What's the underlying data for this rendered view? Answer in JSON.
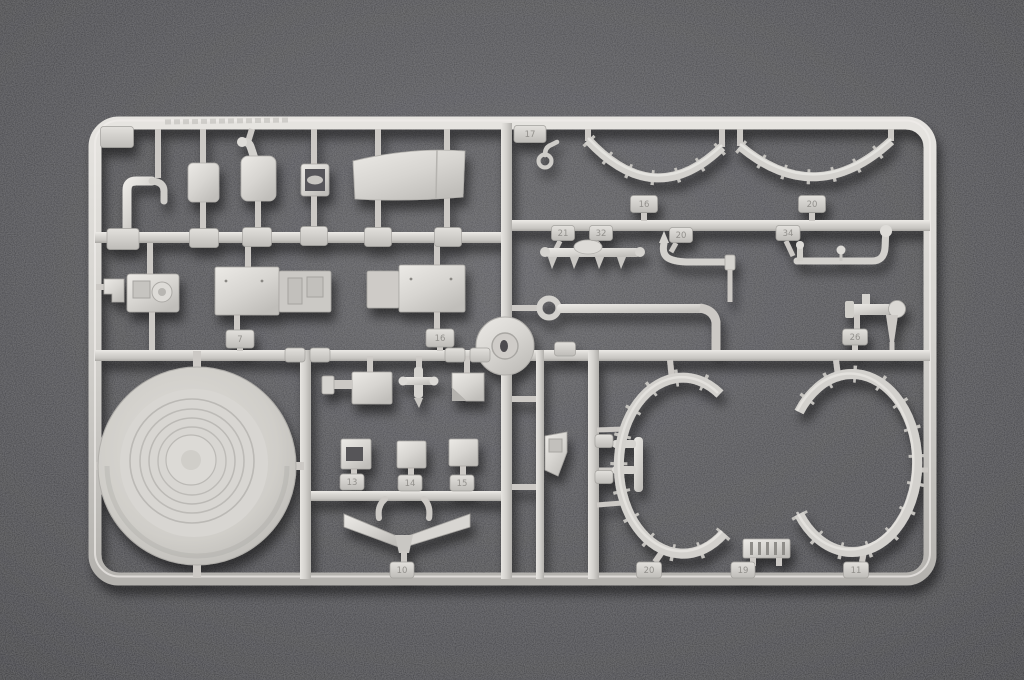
{
  "scene": {
    "type": "photograph",
    "subject": "Light grey injection-molded plastic model kit sprue (parts tree) photographed on dark grey felt fabric",
    "background_color": "#47474b",
    "plastic_color": "#d2d0cc",
    "shadow_color": "#000000",
    "tag_text_color": "#8f8d89"
  },
  "sprue": {
    "corner_tag_label": "",
    "molding_text": "",
    "part_tags": [
      {
        "x": 117,
        "y": 137,
        "w": 33,
        "h": 21,
        "label": ""
      },
      {
        "x": 123,
        "y": 239,
        "w": 32,
        "h": 21,
        "label": ""
      },
      {
        "x": 204,
        "y": 238,
        "w": 29,
        "h": 19,
        "label": ""
      },
      {
        "x": 257,
        "y": 237,
        "w": 29,
        "h": 19,
        "label": ""
      },
      {
        "x": 314,
        "y": 236,
        "w": 27,
        "h": 19,
        "label": ""
      },
      {
        "x": 378,
        "y": 237,
        "w": 27,
        "h": 19,
        "label": ""
      },
      {
        "x": 448,
        "y": 237,
        "w": 27,
        "h": 19,
        "label": ""
      },
      {
        "x": 530,
        "y": 134,
        "w": 32,
        "h": 17,
        "label": "17"
      },
      {
        "x": 644,
        "y": 204,
        "w": 27,
        "h": 17,
        "label": "16"
      },
      {
        "x": 812,
        "y": 204,
        "w": 27,
        "h": 17,
        "label": "20"
      },
      {
        "x": 563,
        "y": 233,
        "w": 23,
        "h": 15,
        "label": "21"
      },
      {
        "x": 601,
        "y": 233,
        "w": 23,
        "h": 15,
        "label": "32"
      },
      {
        "x": 681,
        "y": 235,
        "w": 23,
        "h": 15,
        "label": "20"
      },
      {
        "x": 788,
        "y": 233,
        "w": 24,
        "h": 15,
        "label": "34"
      },
      {
        "x": 240,
        "y": 339,
        "w": 28,
        "h": 18,
        "label": "7"
      },
      {
        "x": 440,
        "y": 338,
        "w": 28,
        "h": 18,
        "label": "16"
      },
      {
        "x": 295,
        "y": 355,
        "w": 20,
        "h": 14,
        "label": ""
      },
      {
        "x": 320,
        "y": 355,
        "w": 20,
        "h": 14,
        "label": ""
      },
      {
        "x": 455,
        "y": 355,
        "w": 20,
        "h": 14,
        "label": ""
      },
      {
        "x": 480,
        "y": 355,
        "w": 20,
        "h": 14,
        "label": ""
      },
      {
        "x": 565,
        "y": 349,
        "w": 21,
        "h": 14,
        "label": ""
      },
      {
        "x": 855,
        "y": 337,
        "w": 25,
        "h": 16,
        "label": "26"
      },
      {
        "x": 352,
        "y": 482,
        "w": 24,
        "h": 16,
        "label": "13"
      },
      {
        "x": 410,
        "y": 483,
        "w": 24,
        "h": 16,
        "label": "14"
      },
      {
        "x": 462,
        "y": 483,
        "w": 24,
        "h": 16,
        "label": "15"
      },
      {
        "x": 402,
        "y": 570,
        "w": 24,
        "h": 16,
        "label": "10"
      },
      {
        "x": 649,
        "y": 570,
        "w": 25,
        "h": 16,
        "label": "20"
      },
      {
        "x": 743,
        "y": 570,
        "w": 24,
        "h": 16,
        "label": "19"
      },
      {
        "x": 856,
        "y": 570,
        "w": 25,
        "h": 16,
        "label": "11"
      },
      {
        "x": 604,
        "y": 441,
        "w": 18,
        "h": 13,
        "label": ""
      },
      {
        "x": 604,
        "y": 477,
        "w": 18,
        "h": 13,
        "label": ""
      }
    ],
    "parts_catalog": [
      "hooked-pipe",
      "small-plate",
      "fuel-canister",
      "seat-frame",
      "curved-roof-panel",
      "side-flag-bracket",
      "round-detail-box",
      "equipment-box-pair-a",
      "equipment-box-pair-b",
      "large-ribbed-disc",
      "round-hub-part",
      "box-with-arm",
      "cross-valve",
      "wedge-block",
      "window-bracket",
      "cube-block-a",
      "cube-block-b",
      "v-shaped-mudguards",
      "angled-bracket",
      "fork-caliper",
      "hook-with-ring",
      "bolted-arc-a",
      "bolted-arc-b",
      "axle-with-cones",
      "s-curved-pipe",
      "l-shaped-rod",
      "long-pipe-with-ring",
      "t-bar-with-disc",
      "bolted-ring-left",
      "bolted-ring-right",
      "slatted-vent"
    ]
  }
}
